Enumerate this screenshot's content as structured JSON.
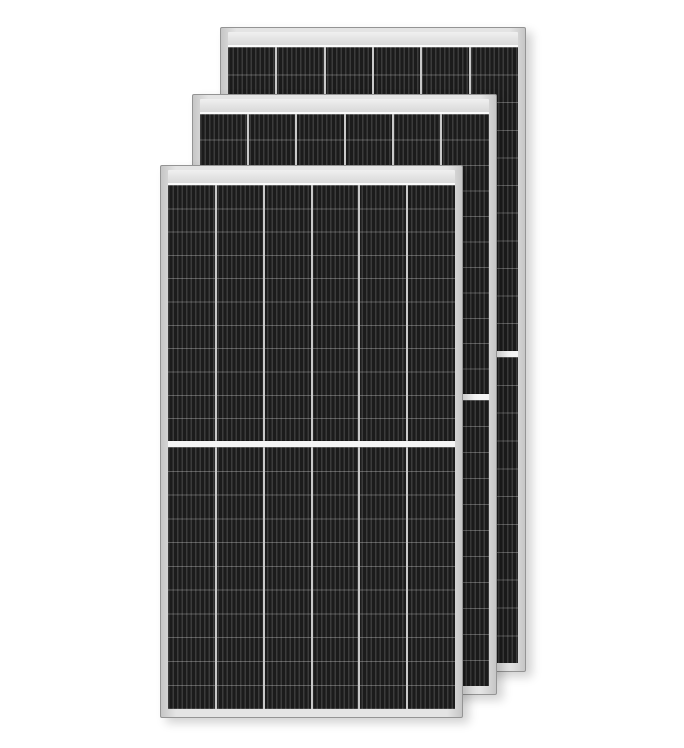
{
  "scene": {
    "description": "Product photo of three overlapping black half-cut monocrystalline solar panels with silver aluminium frames on a plain white background",
    "background_color": "#ffffff",
    "width": 684,
    "height": 748,
    "panel_count": 3
  },
  "panel_style": {
    "columns": 6,
    "rows_per_half": 11,
    "busbar_period_px": 4.5,
    "busbar_light_px": 1.4,
    "frame_edge_color": "#949494",
    "frame_color_light": "#e4e4e4",
    "frame_color_dark": "#c6c6c6",
    "top_bar_color_top": "#f0f0f0",
    "top_bar_color_bottom": "#d9d9d9",
    "glass_line_color": "#fbfbfb",
    "cell_dark": "#1b1b1b",
    "cell_light": "#3b3b3b",
    "column_divider_color": "#c9c9c9",
    "row_line_color": "rgba(235,235,235,0.30)",
    "center_gap_color": "#f5f5f5",
    "shadow": "6px 5px 10px rgba(0,0,0,0.18)"
  },
  "panels": [
    {
      "name": "back-panel",
      "left": 220,
      "top": 27,
      "width": 306,
      "height": 645,
      "gap_fraction": 0.498,
      "z": 1
    },
    {
      "name": "middle-panel",
      "left": 192,
      "top": 94,
      "width": 305,
      "height": 601,
      "gap_fraction": 0.495,
      "z": 2
    },
    {
      "name": "front-panel",
      "left": 160,
      "top": 165,
      "width": 303,
      "height": 553,
      "gap_fraction": 0.495,
      "z": 3
    }
  ]
}
